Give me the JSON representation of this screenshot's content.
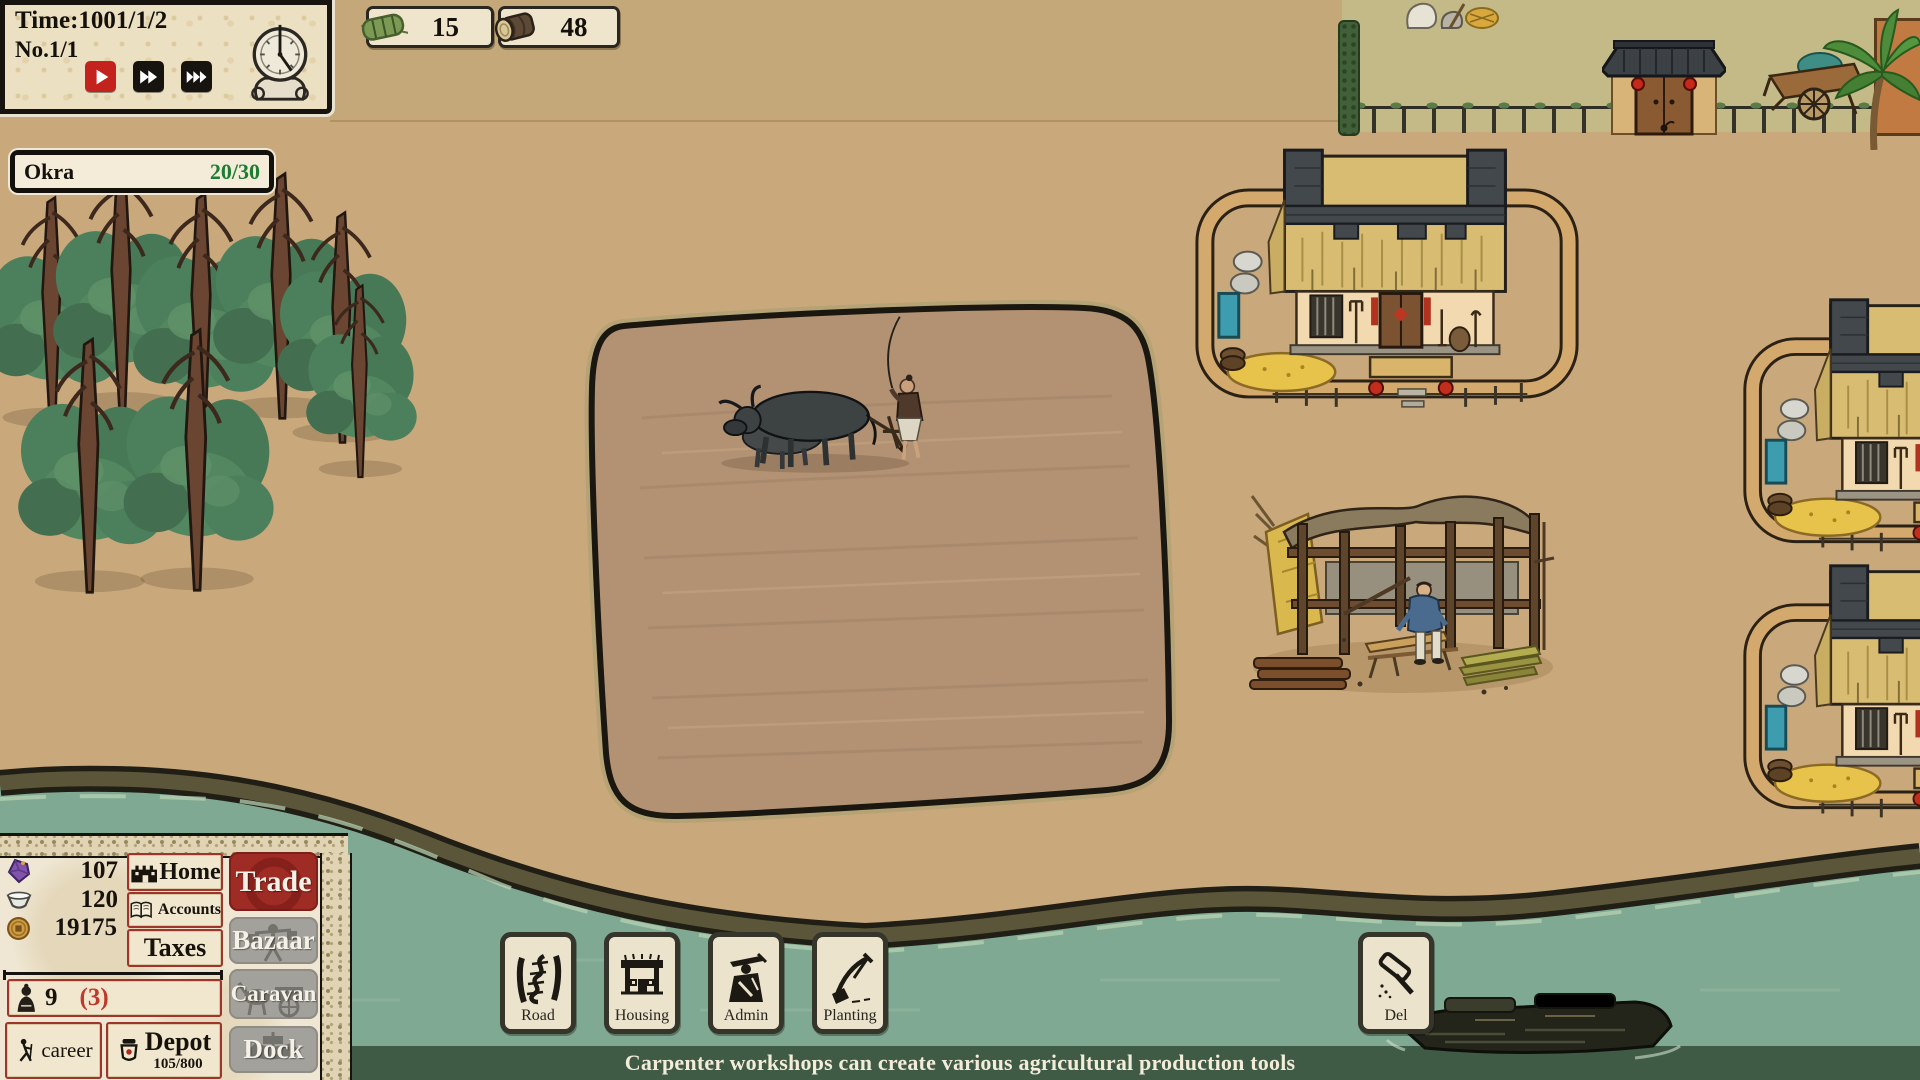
{
  "hud": {
    "time_panel": {
      "time_label": "Time:1001/1/2",
      "round_label": "No.1/1"
    },
    "top_resources": [
      {
        "name": "straw-bundle",
        "icon": "straw-bundle-icon",
        "value": "15"
      },
      {
        "name": "log",
        "icon": "log-icon",
        "value": "48"
      }
    ],
    "selection": {
      "name": "Okra",
      "progress": "20/30"
    }
  },
  "panel": {
    "resources": [
      {
        "name": "gem",
        "icon": "gem-icon",
        "value": "107"
      },
      {
        "name": "bowl",
        "icon": "bowl-icon",
        "value": "120"
      },
      {
        "name": "coin",
        "icon": "coin-icon",
        "value": "19175"
      }
    ],
    "nav": [
      {
        "label": "Home",
        "icon": "home-icon"
      },
      {
        "label": "Accounts",
        "icon": "accounts-icon"
      },
      {
        "label": "Taxes",
        "icon": null
      }
    ],
    "side": [
      {
        "label": "Trade",
        "active": true
      },
      {
        "label": "Bazaar",
        "active": false
      },
      {
        "label": "Caravan",
        "active": false
      },
      {
        "label": "Dock",
        "active": false
      }
    ],
    "population": {
      "count": "9",
      "idle": "(3)",
      "icon": "person-icon"
    },
    "career_label": "career",
    "depot": {
      "label": "Depot",
      "capacity": "105/800",
      "icon": "jar-icon"
    }
  },
  "build_toolbar": [
    {
      "label": "Road",
      "icon": "road-icon"
    },
    {
      "label": "Housing",
      "icon": "housing-icon"
    },
    {
      "label": "Admin",
      "icon": "admin-icon"
    },
    {
      "label": "Planting",
      "icon": "planting-icon"
    }
  ],
  "delete_tool": {
    "label": "Del",
    "icon": "hammer-icon"
  },
  "status_bar": {
    "message": "Carpenter workshops can create various agricultural production tools"
  },
  "icons": {
    "time_controls": [
      "play-icon",
      "fast-forward-icon",
      "fastest-forward-icon",
      "clock-icon"
    ]
  },
  "colors": {
    "accent_red": "#9e2b24",
    "parchment": "#efe6d0",
    "sand": "#c9a87c",
    "water": "#7fa992",
    "bank": "#5b5639",
    "status_bar_green": "#3a5440",
    "progress_green": "#1e7c33",
    "idle_red": "#c0392b"
  }
}
